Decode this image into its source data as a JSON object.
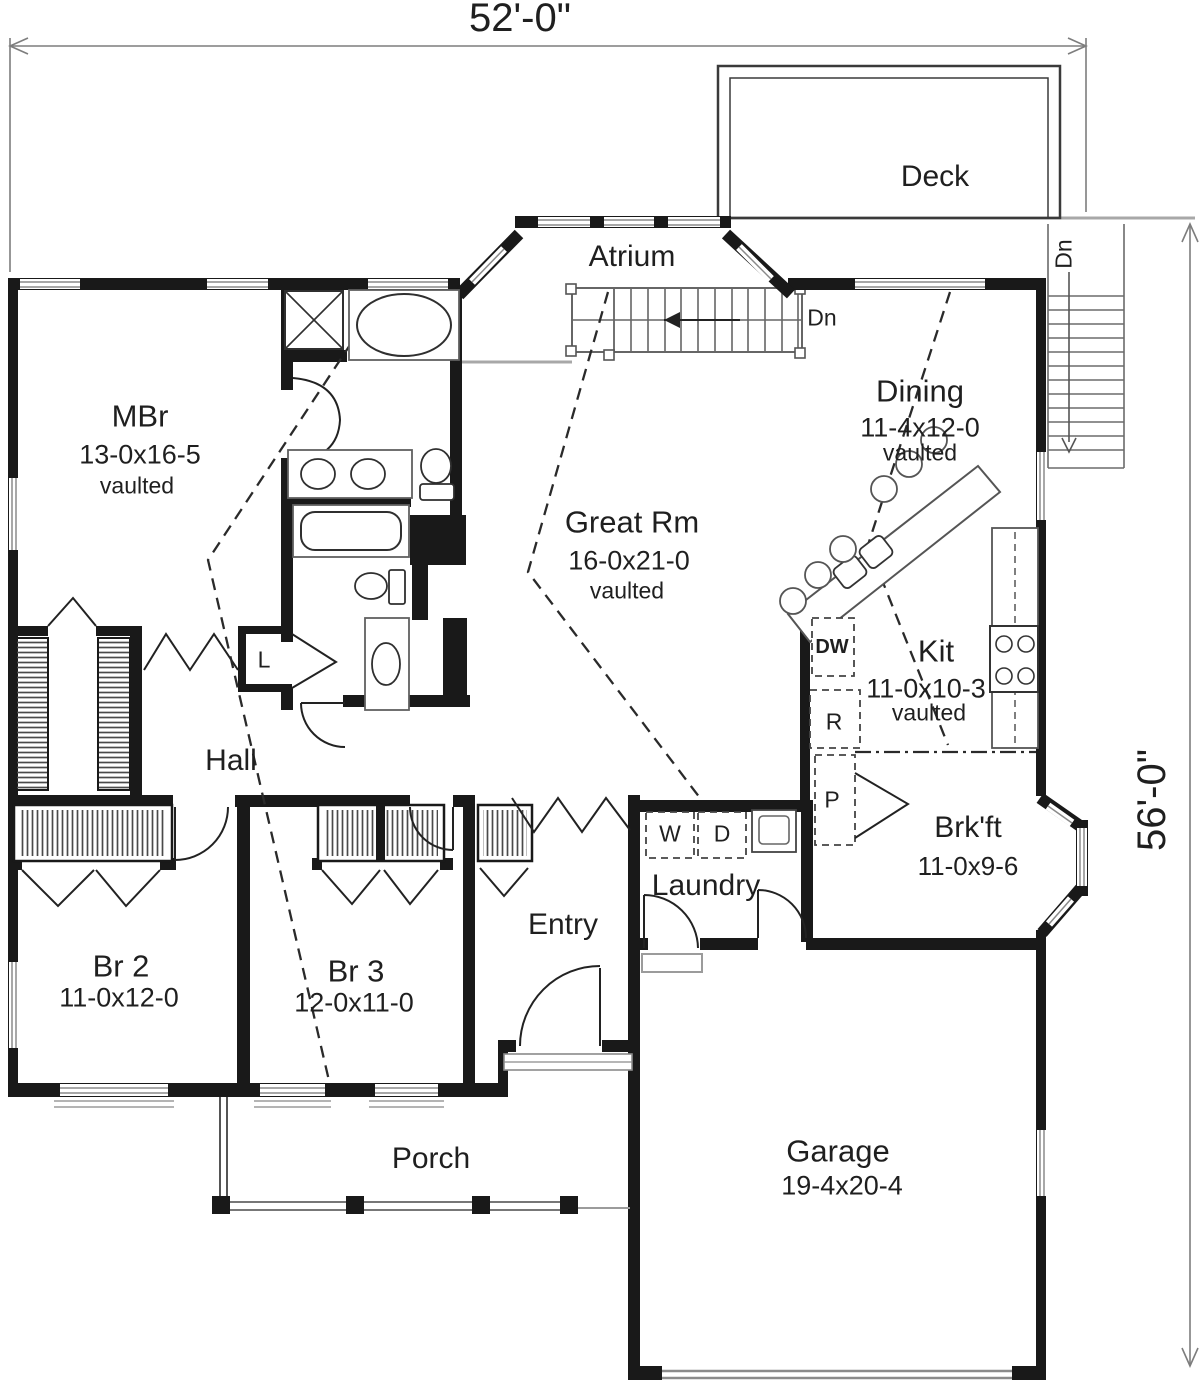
{
  "title": "Single-story house first floor plan",
  "dimensions": {
    "width_label": "52'-0\"",
    "height_label": "56'-0\""
  },
  "rooms": {
    "deck": {
      "name": "Deck"
    },
    "atrium": {
      "name": "Atrium"
    },
    "mbr": {
      "name": "MBr",
      "dims": "13-0x16-5",
      "note": "vaulted"
    },
    "dining": {
      "name": "Dining",
      "dims": "11-4x12-0",
      "note": "vaulted"
    },
    "great_rm": {
      "name": "Great Rm",
      "dims": "16-0x21-0",
      "note": "vaulted"
    },
    "kit": {
      "name": "Kit",
      "dims": "11-0x10-3",
      "note": "vaulted"
    },
    "hall": {
      "name": "Hall"
    },
    "brkft": {
      "name": "Brk'ft",
      "dims": "11-0x9-6"
    },
    "laundry": {
      "name": "Laundry"
    },
    "entry": {
      "name": "Entry"
    },
    "br2": {
      "name": "Br 2",
      "dims": "11-0x12-0"
    },
    "br3": {
      "name": "Br 3",
      "dims": "12-0x11-0"
    },
    "porch": {
      "name": "Porch"
    },
    "garage": {
      "name": "Garage",
      "dims": "19-4x20-4"
    }
  },
  "labels": {
    "washer": "W",
    "dryer": "D",
    "dishwasher": "DW",
    "refrigerator": "R",
    "pantry": "P",
    "linen": "L",
    "stairs_down_interior": "Dn",
    "stairs_down_deck": "Dn"
  },
  "colors": {
    "walls": "#191919",
    "thin_lines": "#555555",
    "light_lines": "#9b9b9b",
    "text": "#1f1f1f",
    "background": "#ffffff"
  }
}
